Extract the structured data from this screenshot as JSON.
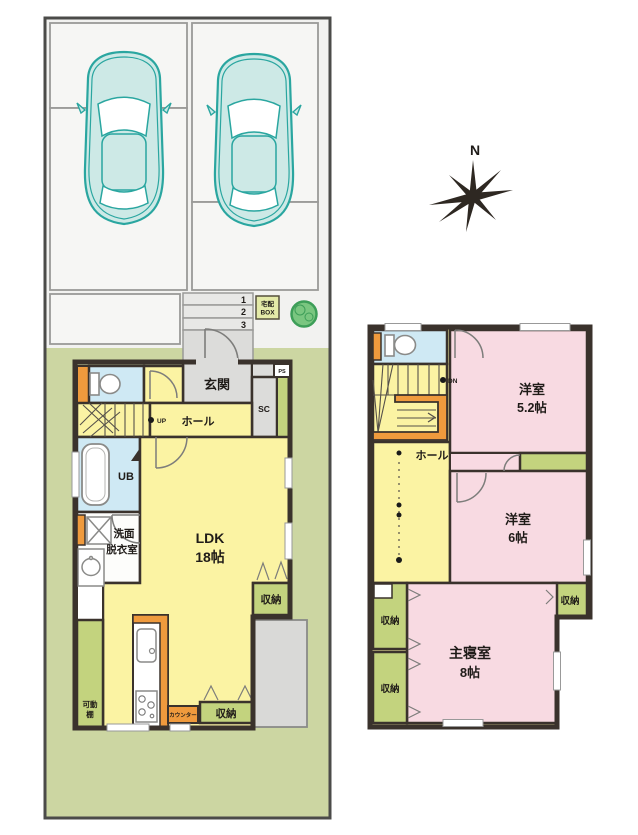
{
  "compass": {
    "north": "N"
  },
  "site": {
    "steps": [
      "1",
      "2",
      "3"
    ],
    "delivery_box": {
      "line1": "宅配",
      "line2": "BOX"
    },
    "car_count": 2
  },
  "floor1": {
    "entrance": "玄関",
    "shoe_closet": "SC",
    "pipe_space": "PS",
    "hall": "ホール",
    "up": "UP",
    "unit_bath": "UB",
    "washroom1": "洗面",
    "washroom2": "脱衣室",
    "ldk1": "LDK",
    "ldk2": "18帖",
    "storage_mid": "収納",
    "storage_bottom": "収納",
    "counter": "カウンター",
    "shelf1": "可動",
    "shelf2": "棚"
  },
  "floor2": {
    "down": "DN",
    "hall": "ホール",
    "room_a1": "洋室",
    "room_a2": "5.2帖",
    "room_b1": "洋室",
    "room_b2": "6帖",
    "master1": "主寝室",
    "master2": "8帖",
    "storage_right": "収納",
    "storage_left_top": "収納",
    "storage_left_bottom": "収納"
  },
  "colors": {
    "wall": "#3a322c",
    "room_yellow": "#fbf3a3",
    "room_pink": "#f8dae2",
    "room_blue": "#cfe9f4",
    "storage_green": "#c3d37e",
    "accent_orange": "#ef9a3d",
    "yard_green": "#ccd6a2",
    "gray_area": "#dcdcda",
    "car_teal": "#2aa6a0",
    "tree_green": "#7ac680"
  }
}
